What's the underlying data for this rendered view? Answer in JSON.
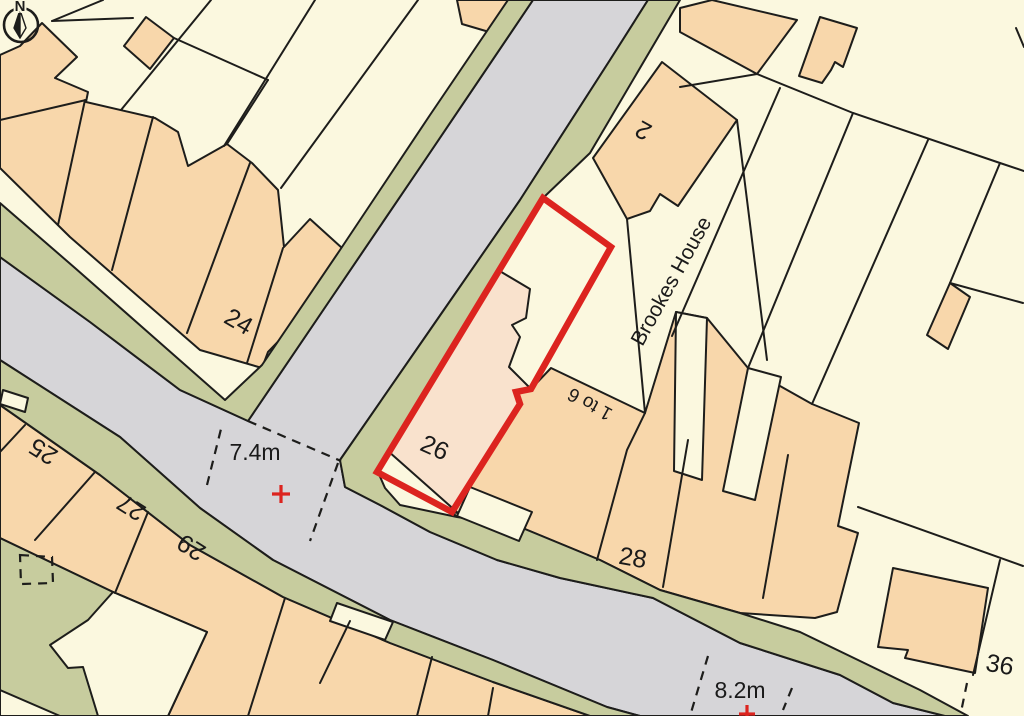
{
  "title": "Site location plan",
  "colors": {
    "cream": "#FBF8DF",
    "orange": "#F8D7AB",
    "plot": "#F9E2CD",
    "verge": "#C7CC9E",
    "road": "#D6D5D8",
    "line": "#1D1D1B",
    "accent": "#DC241F",
    "text": "#1A1A1A"
  },
  "compass": {
    "letter": "N"
  },
  "highlight": {
    "plot_number": "26",
    "outline_color": "#DC241F"
  },
  "map": {
    "labels": [
      {
        "id": "plot-26",
        "text": "26",
        "x": 435,
        "y": 447,
        "rot": 24,
        "fs": 25,
        "kind": "building-number"
      },
      {
        "id": "no-24",
        "text": "24",
        "x": 239,
        "y": 321,
        "rot": 30,
        "fs": 25,
        "kind": "building-number"
      },
      {
        "id": "no-25",
        "text": "25",
        "x": 43,
        "y": 452,
        "rot": 212,
        "fs": 25,
        "kind": "building-number"
      },
      {
        "id": "no-27",
        "text": "27",
        "x": 131,
        "y": 508,
        "rot": 212,
        "fs": 25,
        "kind": "building-number"
      },
      {
        "id": "no-29",
        "text": "29",
        "x": 191,
        "y": 548,
        "rot": 212,
        "fs": 25,
        "kind": "building-number"
      },
      {
        "id": "no-2",
        "text": "2",
        "x": 643,
        "y": 131,
        "rot": 209,
        "fs": 25,
        "kind": "building-number"
      },
      {
        "id": "no-1to6",
        "text": "1 to 6",
        "x": 590,
        "y": 404,
        "rot": 209,
        "fs": 19,
        "kind": "building-number"
      },
      {
        "id": "no-28",
        "text": "28",
        "x": 633,
        "y": 557,
        "rot": 10,
        "fs": 25,
        "kind": "building-number"
      },
      {
        "id": "no-36",
        "text": "36",
        "x": 1000,
        "y": 664,
        "rot": 10,
        "fs": 25,
        "kind": "building-number"
      },
      {
        "id": "brookes-house",
        "text": "Brookes House",
        "x": 671,
        "y": 281,
        "rot": -61,
        "fs": 21,
        "kind": "building-name"
      },
      {
        "id": "width-74",
        "text": "7.4m",
        "x": 255,
        "y": 452,
        "rot": 0,
        "fs": 23,
        "kind": "road-width"
      },
      {
        "id": "width-82",
        "text": "8.2m",
        "x": 740,
        "y": 690,
        "rot": 0,
        "fs": 23,
        "kind": "road-width"
      }
    ]
  }
}
